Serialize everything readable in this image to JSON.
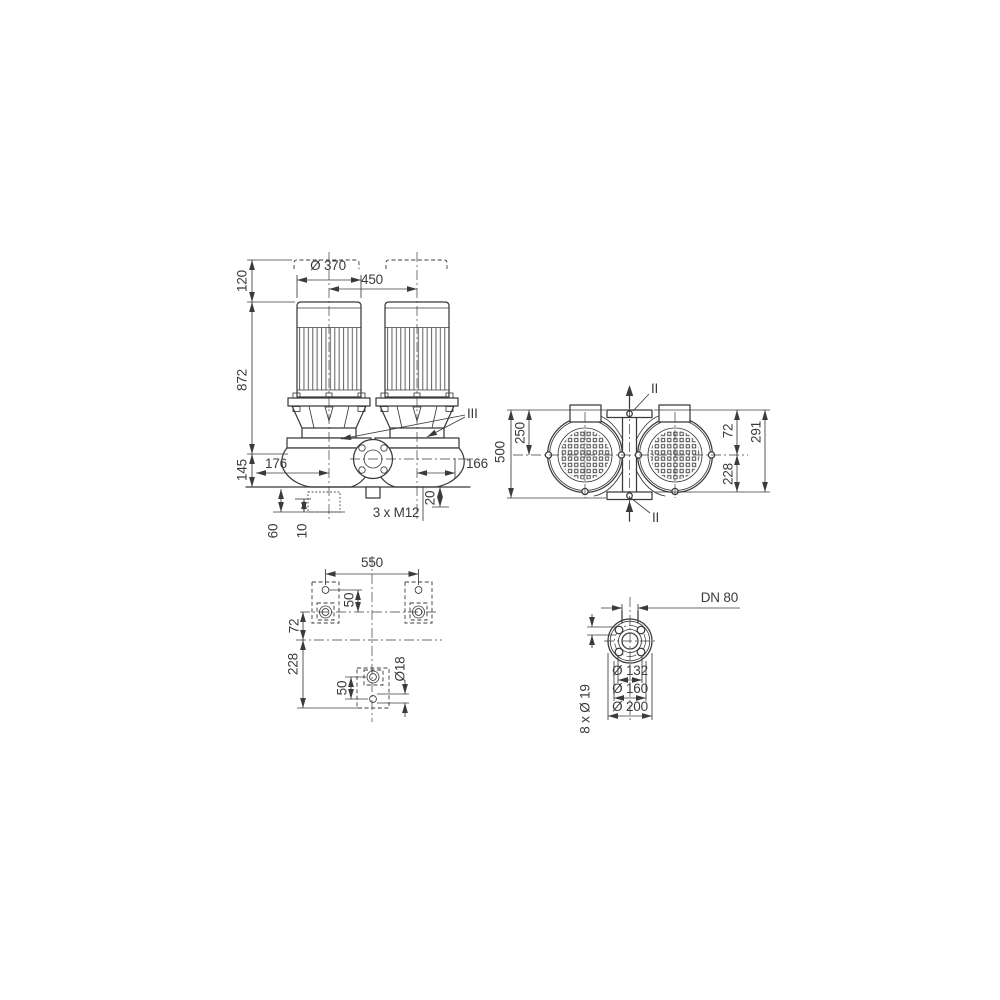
{
  "drawing": {
    "type": "pump-dimensional-drawing",
    "colors": {
      "line": "#3b3b3b",
      "background": "#ffffff"
    },
    "views": {
      "front": {
        "labels": {
          "fan_clearance": "120",
          "total_height": "872",
          "base_height": "145",
          "motor_diameter": "Ø 370",
          "motor_spacing": "450",
          "left_offset": "176",
          "right_offset": "166",
          "section_marker": "III",
          "tapped_holes": "3 x M12",
          "hole_depth": "20",
          "foot_offset": "60",
          "foot_step": "10"
        }
      },
      "top": {
        "labels": {
          "port_to_port": "500",
          "center_to_port": "250",
          "section_marker_top": "II",
          "section_marker_bottom": "II",
          "center_to_edge": "72",
          "overall_depth": "291",
          "center_to_back": "228"
        }
      },
      "foundation": {
        "labels": {
          "bolt_spacing": "550",
          "pad_hole_offset_top": "50",
          "center_offset": "72",
          "rear_offset": "228",
          "pad_hole_offset_bottom": "50",
          "anchor_hole_diameter": "Ø18"
        }
      },
      "flange": {
        "labels": {
          "nominal_diameter": "DN 80",
          "raised_face_diameter": "Ø 132",
          "bolt_circle_diameter": "Ø 160",
          "outer_diameter": "Ø 200",
          "bolt_holes": "8 x Ø 19"
        }
      }
    }
  }
}
